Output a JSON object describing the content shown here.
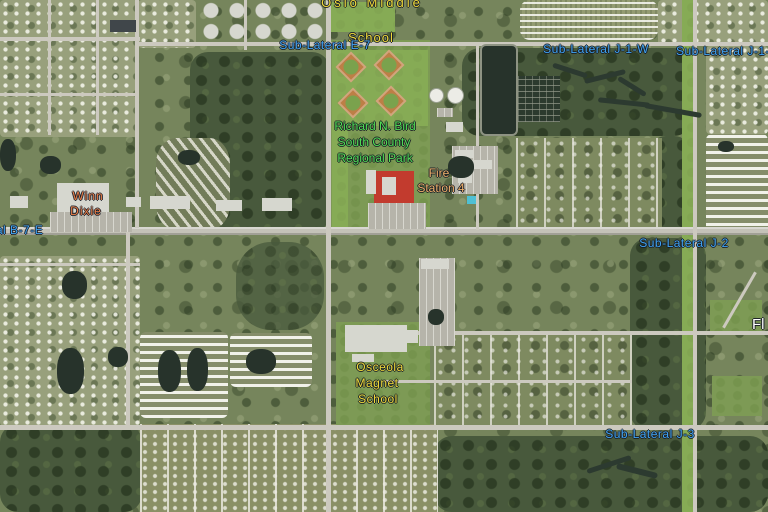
{
  "map_labels": [
    {
      "name": "oslo-middle-school-label",
      "color": "#efda3a",
      "size": 13,
      "lines": [
        {
          "text": "Oslo Middle",
          "cx": 372,
          "y": -5,
          "ls": 3
        },
        {
          "text": "School",
          "cx": 371,
          "y": 30,
          "ls": 1
        }
      ]
    },
    {
      "name": "sub-lateral-e-7-label",
      "color": "#3fa3f2",
      "size": 12,
      "lines": [
        {
          "text": "Sub-Lateral E-7",
          "cx": 325,
          "y": 38,
          "ls": 0.5
        }
      ]
    },
    {
      "name": "sub-lateral-j-1-w-label",
      "color": "#3fa3f2",
      "size": 12,
      "lines": [
        {
          "text": "Sub-Lateral J-1-W",
          "cx": 596,
          "y": 42,
          "ls": 0.5
        }
      ]
    },
    {
      "name": "sub-lateral-j-1-e-label",
      "color": "#3fa3f2",
      "size": 12,
      "lines": [
        {
          "text": "Sub-Lateral J-1-E",
          "lx": 676,
          "y": 44,
          "ls": 0.5
        }
      ]
    },
    {
      "name": "regional-park-label",
      "color": "#50df55",
      "size": 12,
      "lines": [
        {
          "text": "Richard N. Bird",
          "cx": 375,
          "y": 119
        },
        {
          "text": "South County",
          "cx": 374,
          "y": 135
        },
        {
          "text": "Regional Park",
          "cx": 375,
          "y": 151
        }
      ]
    },
    {
      "name": "fire-station-4-label",
      "color": "#eeb06a",
      "size": 12,
      "lines": [
        {
          "text": "Fire",
          "cx": 439,
          "y": 166
        },
        {
          "text": "Station 4",
          "cx": 441,
          "y": 181
        }
      ]
    },
    {
      "name": "winn-dixie-label",
      "color": "#e87c45",
      "size": 12,
      "lines": [
        {
          "text": "Winn",
          "cx": 88,
          "y": 189,
          "ls": 1
        },
        {
          "text": "Dixie",
          "cx": 86,
          "y": 204,
          "ls": 1
        }
      ]
    },
    {
      "name": "lateral-b-7-e-label",
      "color": "#3fa3f2",
      "size": 12,
      "lines": [
        {
          "text": "Lateral B-7-E",
          "lx": -34,
          "y": 223,
          "ls": 0.5
        }
      ]
    },
    {
      "name": "sub-lateral-j-2-label",
      "color": "#3fa3f2",
      "size": 12,
      "lines": [
        {
          "text": "Sub-Lateral J-2",
          "cx": 684,
          "y": 236,
          "ls": 0.5
        }
      ]
    },
    {
      "name": "florida-edge-label",
      "color": "#ffffff",
      "size": 15,
      "lines": [
        {
          "text": "Fl",
          "lx": 752,
          "y": 316
        }
      ]
    },
    {
      "name": "osceola-magnet-school-label",
      "color": "#efda3a",
      "size": 12,
      "lines": [
        {
          "text": "Osceola",
          "cx": 380,
          "y": 360,
          "ls": 0.5
        },
        {
          "text": "Magnet",
          "cx": 377,
          "y": 376,
          "ls": 0.5
        },
        {
          "text": "School",
          "cx": 378,
          "y": 392,
          "ls": 0.5
        }
      ]
    },
    {
      "name": "sub-lateral-j-3-label",
      "color": "#3fa3f2",
      "size": 12,
      "lines": [
        {
          "text": "Sub-Lateral J-3",
          "cx": 650,
          "y": 427,
          "ls": 0.5
        }
      ]
    }
  ]
}
